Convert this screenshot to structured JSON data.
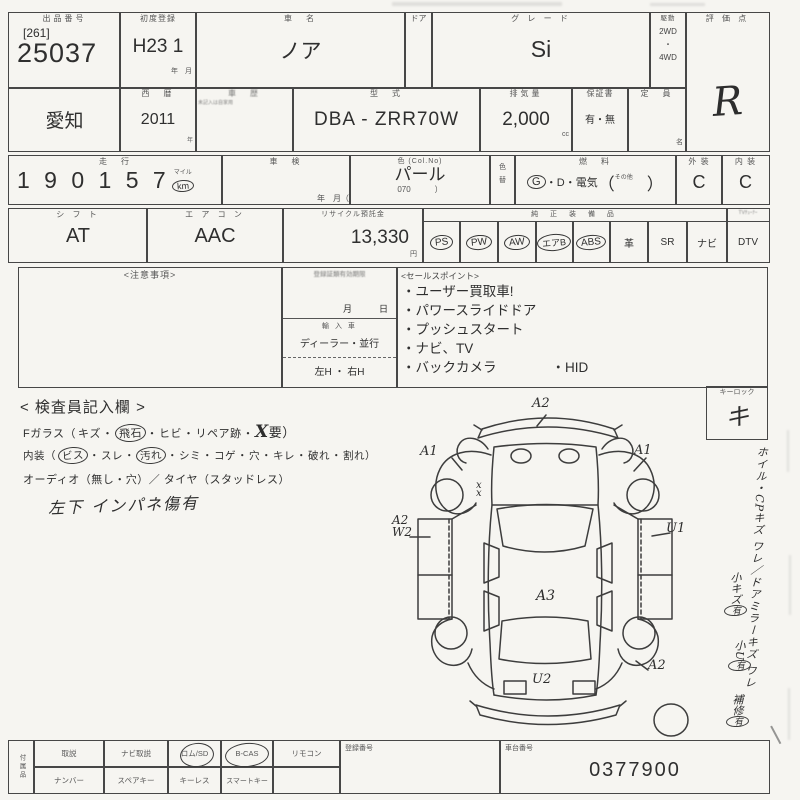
{
  "sheet": {
    "top": {
      "lot_label": "出品番号",
      "lot_aux": "[261]",
      "lot_no": "25037",
      "firstreg_label": "初度登録",
      "firstreg": "H23 1",
      "firstreg_units": "年　月",
      "name_label": "車　名",
      "name": "ノア",
      "door_label": "ドア",
      "grade_label": "グ レ ー ド",
      "grade": "Si",
      "drive_label": "駆動",
      "drive_1": "2WD",
      "drive_dot": "・",
      "drive_2": "4WD",
      "score_label": "評 価 点",
      "score": "R"
    },
    "reg": {
      "prefecture": "愛知",
      "year_label": "西　暦",
      "year": "2011",
      "year_unit": "年",
      "history_label": "車　歴",
      "history_note": "未記入は自家用",
      "model_label": "型　式",
      "model": "DBA - ZRR70W",
      "disp_label": "排気量",
      "disp": "2,000",
      "disp_unit": "cc",
      "warranty_label": "保証書",
      "warranty": "有・無",
      "capacity_label": "定　員",
      "capacity_unit": "名"
    },
    "usage": {
      "mileage_label": "走　行",
      "mileage": "1 9 0  1 5 7",
      "mile_top": "マイル",
      "mile_unit": "km",
      "shaken_label": "車　検",
      "shaken_units": "年　月（",
      "color_label": "色 (Col.No)",
      "color": "パール",
      "color_no_line": "070　　　）",
      "colorchg_1": "色",
      "colorchg_2": "替",
      "fuel_label": "燃　料",
      "fuel_g": "G",
      "fuel_rest": "・D・電気",
      "fuel_open": "（",
      "fuel_other": "その他",
      "fuel_close": "）",
      "ext_label": "外 装",
      "ext": "C",
      "int_label": "内 装",
      "int": "C"
    },
    "spec": {
      "shift_label": "シ フ ト",
      "shift": "AT",
      "ac_label": "エ ア コ ン",
      "ac": "AAC",
      "recycle_label": "リサイクル預託金",
      "recycle": "13,330",
      "recycle_unit": "円",
      "equip_label": "純 正 装 備 品",
      "equip": [
        {
          "label": "PS",
          "circled": true
        },
        {
          "label": "PW",
          "circled": true
        },
        {
          "label": "AW",
          "circled": true
        },
        {
          "label": "エアB",
          "circled": true
        },
        {
          "label": "ABS",
          "circled": true
        },
        {
          "label": "革",
          "circled": false
        },
        {
          "label": "SR",
          "circled": false
        },
        {
          "label": "ナビ",
          "circled": false
        }
      ],
      "dtv_header": "TVﾁｭｰﾅｰ",
      "dtv": "DTV"
    },
    "notice": {
      "label": "<注意事項>"
    },
    "validity": {
      "label": "登録証類有効期限",
      "date_units": "月　　　日",
      "import_label": "輸 入 車",
      "import_opts": "ディーラー・並行",
      "handle_opts": "左H ・ 右H"
    },
    "sales": {
      "label": "<セールスポイント>",
      "points": [
        "・ユーザー買取車!",
        "・パワースライドドア",
        "・プッシュスタート",
        "・ナビ、TV",
        "・バックカメラ"
      ],
      "extra": "・HID"
    },
    "inspector": {
      "title": "< 検査員記入欄 >",
      "l1_pre": "Fガラス（",
      "l1_items": [
        {
          "s": "",
          "t": "キズ",
          "c": false
        },
        {
          "s": "・",
          "t": "飛石",
          "c": true
        },
        {
          "s": "・",
          "t": "ヒビ",
          "c": false
        },
        {
          "s": "・",
          "t": "リペア跡",
          "c": false
        }
      ],
      "l1_sep": "・",
      "l1_x": "X",
      "l1_tail": "要）",
      "l2_pre": "内装（",
      "l2_items": [
        {
          "s": "",
          "t": "ビス",
          "c": true
        },
        {
          "s": "・",
          "t": "スレ",
          "c": false
        },
        {
          "s": "・",
          "t": "汚れ",
          "c": true
        },
        {
          "s": "・",
          "t": "シミ",
          "c": false
        },
        {
          "s": "・",
          "t": "コゲ",
          "c": false
        },
        {
          "s": "・",
          "t": "穴",
          "c": false
        },
        {
          "s": "・",
          "t": "キレ",
          "c": false
        },
        {
          "s": "・",
          "t": "破れ",
          "c": false
        },
        {
          "s": "・",
          "t": "割れ",
          "c": false
        }
      ],
      "l2_close": "）",
      "l3": "オーディオ（無し・穴）／ タイヤ（スタッドレス）",
      "hand_note": "左下 インパネ傷有"
    },
    "diagram": {
      "marks": {
        "front": "A2",
        "front_left": "A1",
        "front_right": "A1",
        "xx1": "x",
        "xx2": "x",
        "left_a": "A2",
        "left_b": "W2",
        "right": "U1",
        "roof": "A3",
        "rear_right": "A2",
        "rear": "U2"
      }
    },
    "sidebar": {
      "keylock_label": "キーロック",
      "keylock": "キ",
      "note_col": "ホイル・CPキズ ワレ／ドアミラーキズ ワレ",
      "hand1": "小キズ",
      "hand1_mark": "有",
      "hand2": "小U",
      "hand2_mark": "有",
      "hand3": "補修",
      "hand3_mark": "有"
    },
    "bottom": {
      "side_label": "付属品",
      "r1": [
        {
          "t": "取説"
        },
        {
          "t": "ナビ取説"
        },
        {
          "t": "ロム/SD"
        },
        {
          "t": "B-CAS"
        },
        {
          "t": "リモコン"
        }
      ],
      "r2": [
        {
          "t": "ナンバー"
        },
        {
          "t": "スペアキー"
        },
        {
          "t": "キーレス"
        },
        {
          "t": "スマートキー"
        },
        {
          "t": ""
        }
      ],
      "regno_label": "登録番号",
      "chassis_label": "車台番号",
      "chassis": "0377900"
    }
  }
}
